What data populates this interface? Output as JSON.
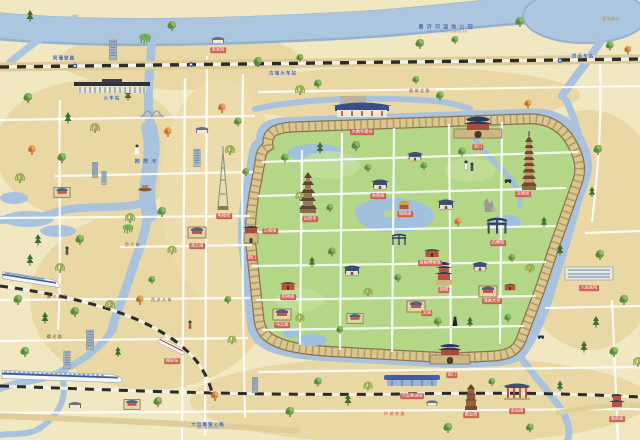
{
  "map": {
    "kind": "illustrated ancient walled city tourist map",
    "colors": {
      "land": "#f1e7c0",
      "land_patch": "#e9d8a4",
      "water": "#a9c3de",
      "water_edge": "#93b2d2",
      "city_green": "#b4d687",
      "wall": "#dbc68e",
      "wall_edge": "#8a7450",
      "road": "#ffffff",
      "rail": "#2b2b2b",
      "site_label": "#d4685c",
      "blue_label": "#3c5fa8"
    }
  },
  "labels": [
    {
      "text": "惠济河湿地公园",
      "sub": "HUIJIHE SHIDI GONGYUAN",
      "x": 447,
      "y": 30,
      "cls": "water"
    },
    {
      "text": "柳根河",
      "x": 147,
      "y": 163,
      "cls": "water"
    },
    {
      "text": "湿地渡口",
      "x": 611,
      "y": 19,
      "cls": "area"
    },
    {
      "text": "同蒲铁路",
      "x": 64,
      "y": 59,
      "cls": "blue"
    },
    {
      "text": "古城火车站",
      "x": 283,
      "y": 74,
      "cls": "blue"
    },
    {
      "text": "货运东站",
      "x": 583,
      "y": 57,
      "cls": "blue"
    },
    {
      "text": "火车站",
      "x": 112,
      "y": 99,
      "cls": "blue"
    },
    {
      "text": "大运高速公路",
      "sub": "DAYUN EXPWY",
      "x": 208,
      "y": 427,
      "cls": "blue"
    },
    {
      "text": "顺城北路",
      "x": 420,
      "y": 91,
      "cls": "street"
    },
    {
      "text": "西大街",
      "x": 133,
      "y": 245,
      "cls": "street"
    },
    {
      "text": "西关大街",
      "x": 162,
      "y": 300,
      "cls": "street"
    },
    {
      "text": "康宁西路",
      "x": 58,
      "y": 297,
      "cls": "street"
    },
    {
      "text": "曙光路",
      "x": 55,
      "y": 337,
      "cls": "street"
    },
    {
      "text": "环城南路",
      "x": 395,
      "y": 414,
      "cls": "streetred"
    },
    {
      "text": "大佛寺遗址",
      "x": 362,
      "y": 132,
      "cls": "site"
    },
    {
      "text": "北门",
      "x": 478,
      "y": 147,
      "cls": "site"
    },
    {
      "text": "文峰塔",
      "x": 523,
      "y": 194,
      "cls": "site"
    },
    {
      "text": "白塔寺",
      "x": 310,
      "y": 219,
      "cls": "site"
    },
    {
      "text": "关帝庙",
      "x": 378,
      "y": 196,
      "cls": "site"
    },
    {
      "text": "城隍庙",
      "x": 405,
      "y": 214,
      "cls": "site"
    },
    {
      "text": "石牌坊",
      "x": 498,
      "y": 243,
      "cls": "site"
    },
    {
      "text": "县衙博物馆",
      "x": 430,
      "y": 263,
      "cls": "site"
    },
    {
      "text": "钟楼",
      "x": 444,
      "y": 290,
      "cls": "site"
    },
    {
      "text": "清真大寺",
      "x": 492,
      "y": 301,
      "cls": "site"
    },
    {
      "text": "文庙",
      "x": 427,
      "y": 313,
      "cls": "site"
    },
    {
      "text": "财神庙",
      "x": 288,
      "y": 297,
      "cls": "site"
    },
    {
      "text": "马王庙",
      "x": 282,
      "y": 325,
      "cls": "site"
    },
    {
      "text": "古城墙",
      "x": 270,
      "y": 231,
      "cls": "site"
    },
    {
      "text": "西门",
      "x": 252,
      "y": 258,
      "cls": "site"
    },
    {
      "text": "南门",
      "x": 452,
      "y": 375,
      "cls": "site"
    },
    {
      "text": "城际站",
      "x": 172,
      "y": 361,
      "cls": "site"
    },
    {
      "text": "汽车客运站",
      "x": 412,
      "y": 396,
      "cls": "site"
    },
    {
      "text": "慈云塔",
      "x": 471,
      "y": 415,
      "cls": "site"
    },
    {
      "text": "东岳庙",
      "x": 517,
      "y": 411,
      "cls": "site"
    },
    {
      "text": "观音阁",
      "x": 617,
      "y": 419,
      "cls": "site"
    },
    {
      "text": "人民医院",
      "x": 589,
      "y": 288,
      "cls": "site"
    },
    {
      "text": "电视塔",
      "x": 224,
      "y": 216,
      "cls": "site"
    },
    {
      "text": "龙王庙",
      "x": 197,
      "y": 246,
      "cls": "site"
    },
    {
      "text": "农家院",
      "x": 218,
      "y": 50,
      "cls": "site"
    }
  ]
}
